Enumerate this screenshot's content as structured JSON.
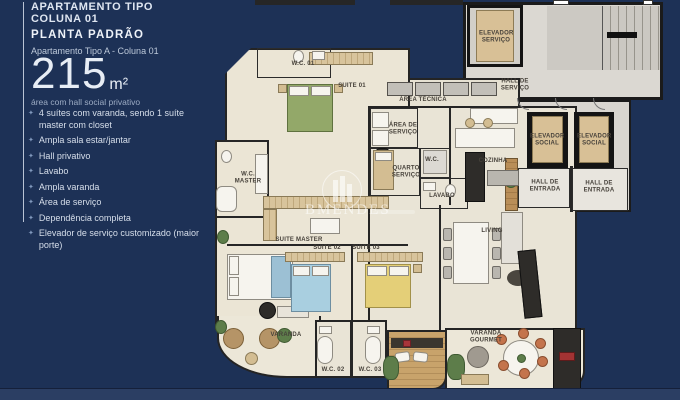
{
  "colors": {
    "navy": "#1d3156",
    "bottom_bar": "#2b3e63",
    "floor_beige": "#ebe5d5",
    "floor_gray": "#dbd8d2",
    "wall": "#242424"
  },
  "sidebar": {
    "title_line1": "APARTAMENTO TIPO",
    "title_line2": "COLUNA 01",
    "subtitle": "PLANTA PADRÃO",
    "plan_label": "Apartamento Tipo A - Coluna 01",
    "area_value": "215",
    "area_unit": "m²",
    "area_note": "área com hall social privativo",
    "bullet_icon": "✦",
    "features": [
      "4 suítes com varanda, sendo 1 suíte master com closet",
      "Ampla sala estar/jantar",
      "Hall privativo",
      "Lavabo",
      "Ampla varanda",
      "Área de serviço",
      "Dependência completa",
      "Elevador de serviço customizado (maior porte)"
    ]
  },
  "plan": {
    "watermark": "BMENDES",
    "rooms": {
      "wc01": "W.C. 01",
      "suite01": "SUITE 01",
      "area_tecnica": "ÁREA TÉCNICA",
      "elevador_servico": "ELEVADOR SERVIÇO",
      "hall_servico": "HALL DE SERVIÇO",
      "area_servico": "ÁREA DE SERVIÇO",
      "quarto_servico": "QUARTO SERVIÇO",
      "wc_servico": "W.C.",
      "lavabo": "LAVABO",
      "cozinha": "COZINHA",
      "elevador_social": "ELEVADOR SOCIAL",
      "hall_entrada": "HALL DE ENTRADA",
      "wc_master": "W.C. MASTER",
      "suite_master": "SUITE MASTER",
      "suite02": "SUITE 02",
      "suite03": "SUITE 03",
      "living": "LIVING",
      "varanda": "VARANDA",
      "wc02": "W.C. 02",
      "wc03": "W.C. 03",
      "varanda_gourmet": "VARANDA GOURMET"
    }
  }
}
